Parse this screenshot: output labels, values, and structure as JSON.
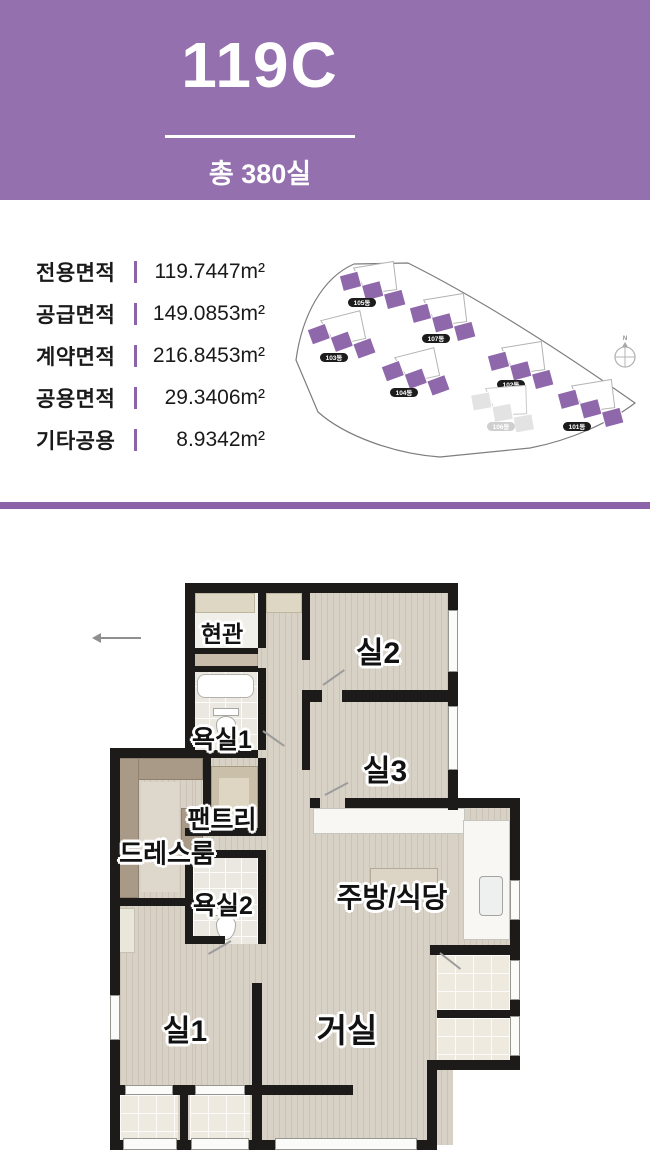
{
  "header": {
    "title": "119C",
    "subtitle": "총 380실"
  },
  "area_specs": {
    "rows": [
      {
        "label": "전용면적",
        "value": "119.7447m²"
      },
      {
        "label": "공급면적",
        "value": "149.0853m²"
      },
      {
        "label": "계약면적",
        "value": "216.8453m²"
      },
      {
        "label": "공용면적",
        "value": "29.3406m²"
      },
      {
        "label": "기타공용",
        "value": "8.9342m²"
      }
    ]
  },
  "site_plan": {
    "compass_label": "N",
    "buildings": [
      {
        "label": "105동",
        "state": "highlighted"
      },
      {
        "label": "103동",
        "state": "highlighted"
      },
      {
        "label": "107동",
        "state": "highlighted"
      },
      {
        "label": "104동",
        "state": "highlighted"
      },
      {
        "label": "102동",
        "state": "highlighted"
      },
      {
        "label": "106동",
        "state": "dimmed"
      },
      {
        "label": "101동",
        "state": "highlighted"
      }
    ]
  },
  "floor_plan": {
    "rooms": [
      {
        "label": "현관"
      },
      {
        "label": "실2"
      },
      {
        "label": "욕실1"
      },
      {
        "label": "실3"
      },
      {
        "label": "팬트리"
      },
      {
        "label": "드레스룸"
      },
      {
        "label": "욕실2"
      },
      {
        "label": "주방/식당"
      },
      {
        "label": "실1"
      },
      {
        "label": "거실"
      }
    ]
  },
  "colors": {
    "accent": "#9470ae",
    "accent_dark": "#8c63a9",
    "wall": "#1d1b19"
  }
}
